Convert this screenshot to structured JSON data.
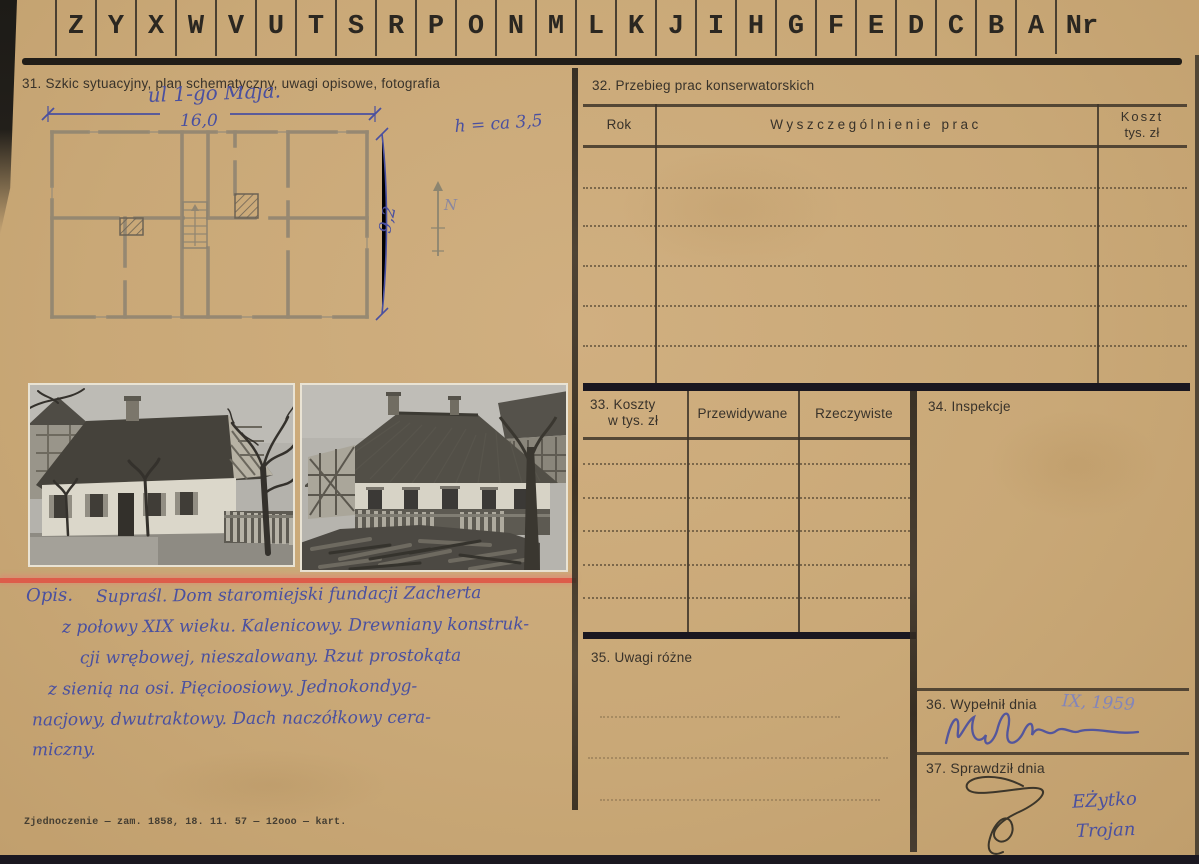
{
  "card": {
    "index_strip": {
      "letters": [
        "Z",
        "Y",
        "X",
        "W",
        "V",
        "U",
        "T",
        "S",
        "R",
        "P",
        "O",
        "N",
        "M",
        "L",
        "K",
        "J",
        "I",
        "H",
        "G",
        "F",
        "E",
        "D",
        "C",
        "B",
        "A"
      ],
      "nr": "Nr"
    },
    "s31": {
      "title": "31. Szkic sytuacyjny, plan schematyczny, uwagi opisowe, fotografia",
      "plan": {
        "street": "ul 1-go Maja.",
        "width_dim": "16,0",
        "depth_dim": "9,2",
        "height_note": "h = ca 3,5",
        "north": "N"
      },
      "opis_label": "Opis.",
      "opis_lines": [
        "Supraśl. Dom staromiejski fundacji Zacherta",
        "z połowy XIX wieku. Kalenicowy. Drewniany konstruk-",
        "cji wrębowej, nieszalowany. Rzut prostokąta",
        "z sienią na osi. Pięcioosiowy. Jednokondyg-",
        "nacjowy, dwutraktowy. Dach naczółkowy cera-",
        "miczny."
      ],
      "print_footer": "Zjednoczenie — zam. 1858, 18. 11. 57 — 12ooo — kart."
    },
    "s32": {
      "title": "32. Przebieg prac konserwatorskich",
      "col_rok": "Rok",
      "col_prace": "Wyszczególnienie prac",
      "col_koszt_1": "Koszt",
      "col_koszt_2": "tys. zł"
    },
    "s33": {
      "title_1": "33. Koszty",
      "title_2": "w tys. zł",
      "col_przewidywane": "Przewidywane",
      "col_rzeczywiste": "Rzeczywiste"
    },
    "s34": {
      "title": "34. Inspekcje"
    },
    "s35": {
      "title": "35. Uwagi różne"
    },
    "s36": {
      "title": "36. Wypełnił dnia",
      "date": "IX, 1959"
    },
    "s37": {
      "title": "37. Sprawdził dnia",
      "name_1": "EŻytko",
      "name_2": "Trojan"
    }
  }
}
